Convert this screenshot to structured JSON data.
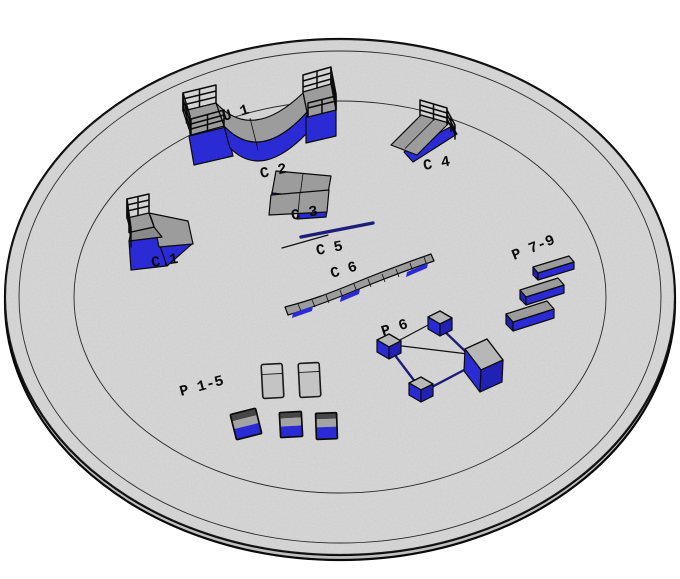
{
  "labels": {
    "halfpipe": "U 1",
    "quarterpipe": "C 1",
    "kicker_upper": "C 2",
    "kicker_lower": "C 3",
    "bank_ramp": "C 4",
    "flat_rail": "C 5",
    "curved_ledge": "C 6",
    "pads_group": "P 1-5",
    "rail_box_group": "P 6",
    "ledges_group": "P 7-9"
  },
  "colors": {
    "background": "#ffffff",
    "platform_surface": "#d8d8d8",
    "platform_edge": "#c0c0c0",
    "obstacle_gray": "#9c9c9c",
    "obstacle_blue": "#2b2bd6",
    "obstacle_blue_dark": "#2121b4",
    "rail_navy": "#1d1d7a",
    "outline": "#0a0a0a",
    "label_color": "#0a0a0a"
  }
}
